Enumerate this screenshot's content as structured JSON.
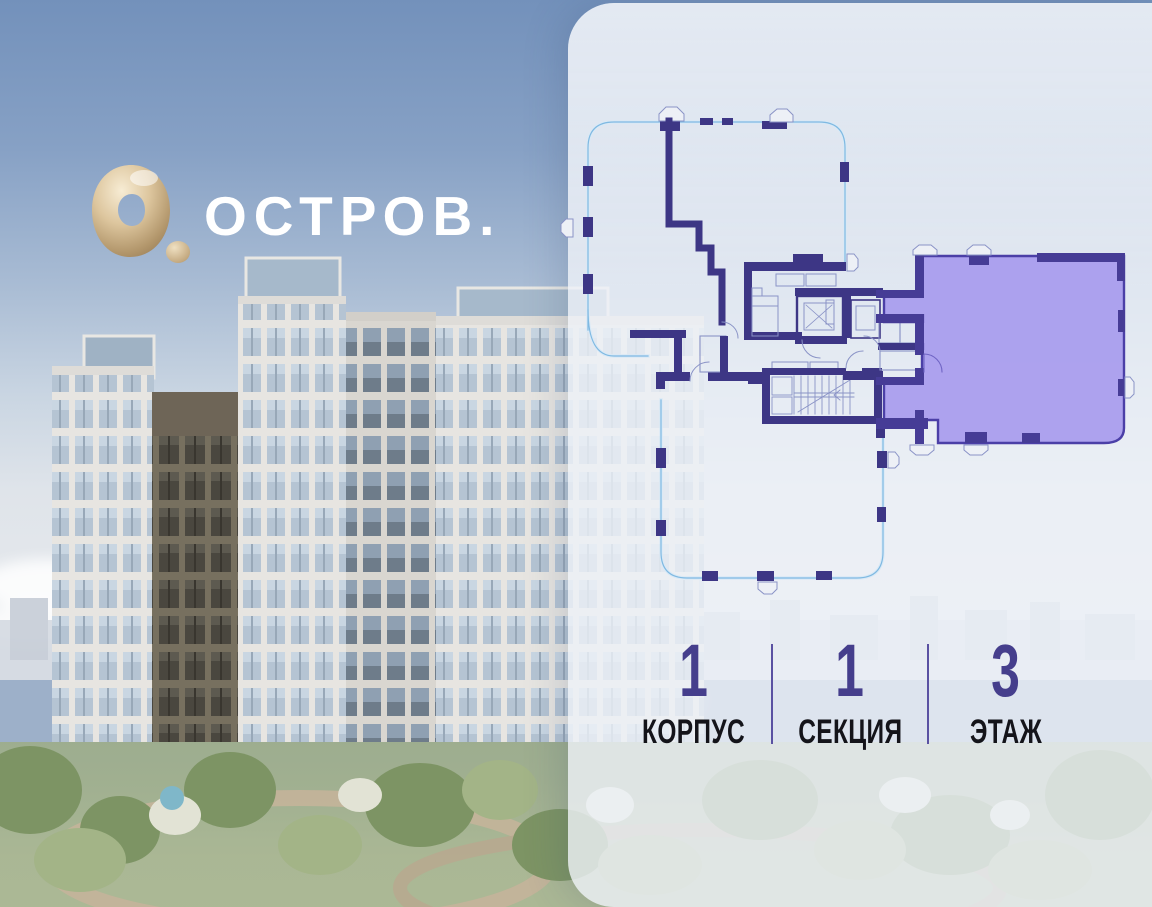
{
  "brand": {
    "logo_text": "ОСТРОВ.",
    "logo_mark": "gold-ring-with-dot"
  },
  "info_bar": {
    "items": [
      {
        "value": "1",
        "label": "КОРПУС"
      },
      {
        "value": "1",
        "label": "СЕКЦИЯ"
      },
      {
        "value": "3",
        "label": "ЭТАЖ"
      }
    ]
  },
  "floor_plan": {
    "building": "1",
    "section": "1",
    "floor": "3",
    "selected_apartment_highlighted": true,
    "elements": [
      "floor-outline",
      "elevators",
      "staircase",
      "bedroom",
      "corridor",
      "selected-apartment"
    ]
  },
  "colors": {
    "accent": "#453e8c",
    "accent_divider": "#5a51a2",
    "plan_wall": "#3d3685",
    "apartment_fill": "#a89cee",
    "apartment_outline": "#4b3fa7",
    "glazing_line": "#7fb9e2",
    "thin_line": "#8a93c6",
    "panel_bg": "rgba(238,241,247,0.80)",
    "logo_gold": "#cfb288",
    "sky_top": "#7391bb"
  }
}
